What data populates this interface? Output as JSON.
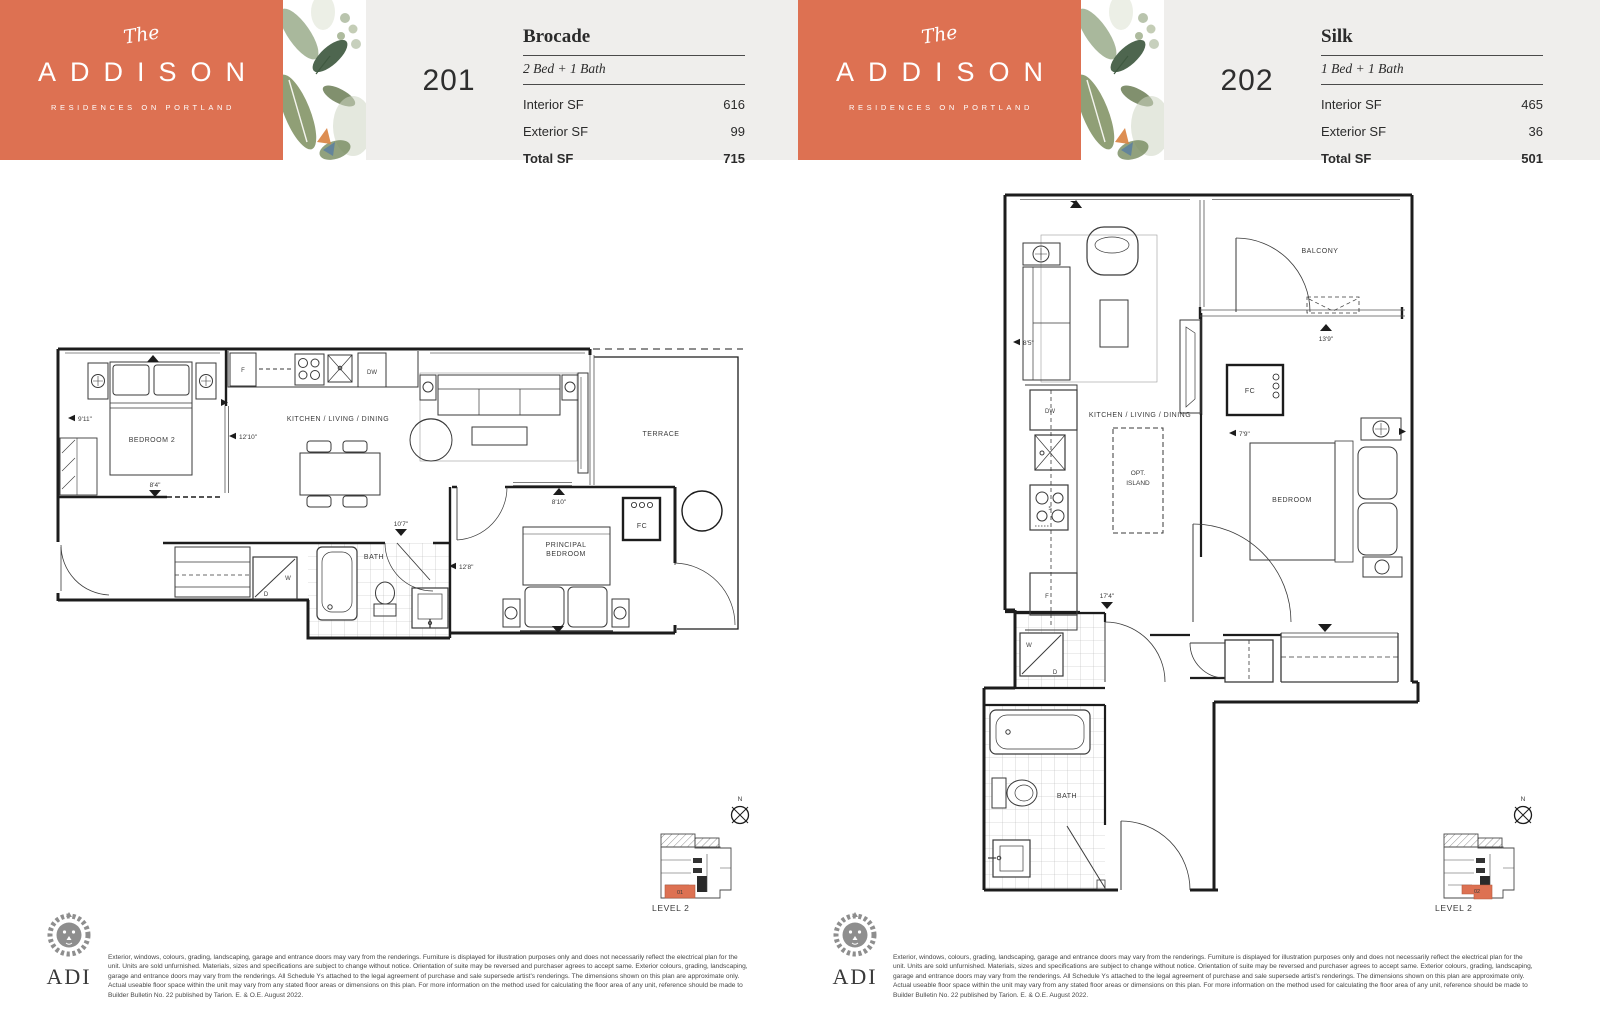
{
  "brand": {
    "the": "The",
    "name": "ADDISON",
    "tagline": "RESIDENCES ON PORTLAND",
    "orange": "#dd7152"
  },
  "units": [
    {
      "number": "201",
      "name": "Brocade",
      "config": "2 Bed + 1 Bath",
      "interior_label": "Interior SF",
      "interior_value": "616",
      "exterior_label": "Exterior SF",
      "exterior_value": "99",
      "total_label": "Total SF",
      "total_value": "715",
      "keyplan_unit": "01",
      "level": "LEVEL 2"
    },
    {
      "number": "202",
      "name": "Silk",
      "config": "1 Bed + 1 Bath",
      "interior_label": "Interior SF",
      "interior_value": "465",
      "exterior_label": "Exterior SF",
      "exterior_value": "36",
      "total_label": "Total SF",
      "total_value": "501",
      "keyplan_unit": "02",
      "level": "LEVEL 2"
    }
  ],
  "plan_common": {
    "north": "N"
  },
  "plan201": {
    "bedroom2": "BEDROOM 2",
    "kld": "KITCHEN / LIVING / DINING",
    "terrace": "TERRACE",
    "principal1": "PRINCIPAL",
    "principal2": "BEDROOM",
    "bath": "BATH",
    "fc": "FC",
    "fridge": "F",
    "dw": "DW",
    "washer": "W",
    "dryer": "D",
    "dim_bedroom2_h": "9'11\"",
    "dim_bedroom2_w": "12'10\"",
    "dim_bedroom2_b": "8'4\"",
    "dim_living": "8'10\"",
    "dim_bath": "10'7\"",
    "dim_principal": "12'8\""
  },
  "plan202": {
    "balcony": "BALCONY",
    "kld": "KITCHEN / LIVING / DINING",
    "bedroom": "BEDROOM",
    "bath": "BATH",
    "opt1": "OPT.",
    "opt2": "ISLAND",
    "fc": "FC",
    "dw": "DW",
    "fridge": "F",
    "stove": "S",
    "washer": "W",
    "dryer": "D",
    "dim_living": "8'5\"",
    "dim_balcony": "13'9\"",
    "dim_bedroom": "7'9\"",
    "dim_kitchen": "17'4\""
  },
  "footer": {
    "logo_text": "ADI",
    "disclaimer": "Exterior, windows, colours, grading, landscaping, garage and entrance doors may vary from the renderings. Furniture is displayed for illustration purposes only and does not necessarily reflect the electrical plan for the unit. Units are sold unfurnished. Materials, sizes and specifications are subject to change without notice. Orientation of suite may be reversed and purchaser agrees to accept same. Exterior colours, grading, landscaping, garage and entrance doors may vary from the renderings. All Schedule Ys attached to the legal agreement of purchase and sale supersede artist's renderings. The dimensions shown on this plan are approximate only. Actual useable floor space within the unit may vary from any stated floor areas or dimensions on this plan. For more information on the method used for calculating the floor area of any unit, reference should be made to Builder Bulletin No. 22 published by Tarion. E. & O.E. August 2022."
  }
}
